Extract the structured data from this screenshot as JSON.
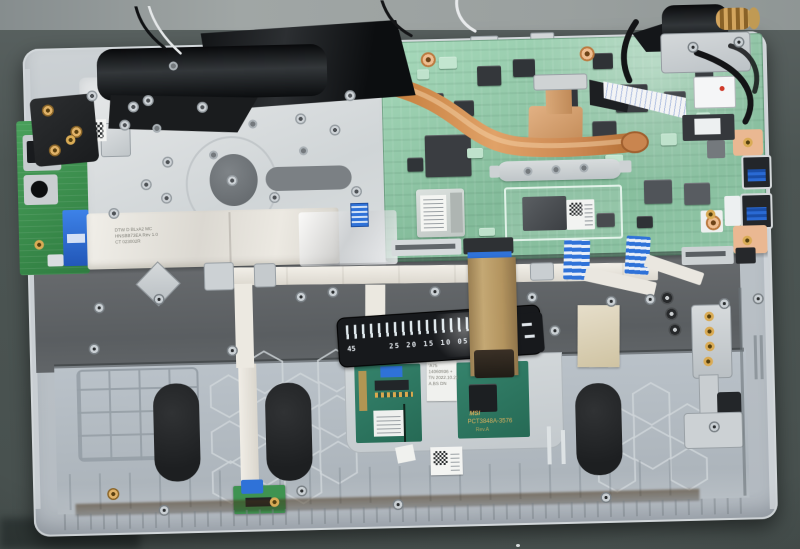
{
  "scene": {
    "subject": "Opened laptop internals viewed from above on a dark workbench",
    "modules": [
      "left hinge",
      "right hinge",
      "antenna cables",
      "io daughterboard",
      "keyboard shield plate",
      "black fan cover",
      "motherboard",
      "copper heat pipe",
      "wifi module",
      "cpu die",
      "usb ports",
      "display cable",
      "keyboard ribbon",
      "ruler flex cable",
      "touchpad boards",
      "battery bay",
      "speaker pads",
      "battery led board"
    ]
  },
  "labels": {
    "ruler_flex": {
      "left_mark": "45",
      "scale_marks": "25 20 15 10 05"
    },
    "touchpad_board": {
      "logo": "MSI",
      "part_number": "PCT3848A-3576",
      "rev": "Rev.A"
    },
    "service_sticker": {
      "line1": "'A75",
      "line2": "14060936 +",
      "line3": "TN 2022.10.21",
      "line4": "A.BS   DN"
    },
    "ffc_cable_marking": {
      "line1": "DTW D BLxA2 MC",
      "line2": "HNSBB73EA  Rev 1.0",
      "line3": "CT 023002R"
    }
  },
  "colors": {
    "desk_dark": "#4c5553",
    "desk_top_strip": "#9aa09f",
    "chassis_silver": "#c2c8cc",
    "keyboard_plate": "#dde0e1",
    "palmrest_dark": "#5e6265",
    "battery_bay": "#b4bcc3",
    "motherboard_green": "#8fc6a7",
    "io_board_green": "#3f9351",
    "touchpad_green": "#2e7f67",
    "copper": "#c9854f",
    "ffc_blue": "#2f72d8",
    "pad_black": "#232527",
    "ribbon_white": "#ece9e2",
    "kapton_tan": "#b5995f"
  }
}
